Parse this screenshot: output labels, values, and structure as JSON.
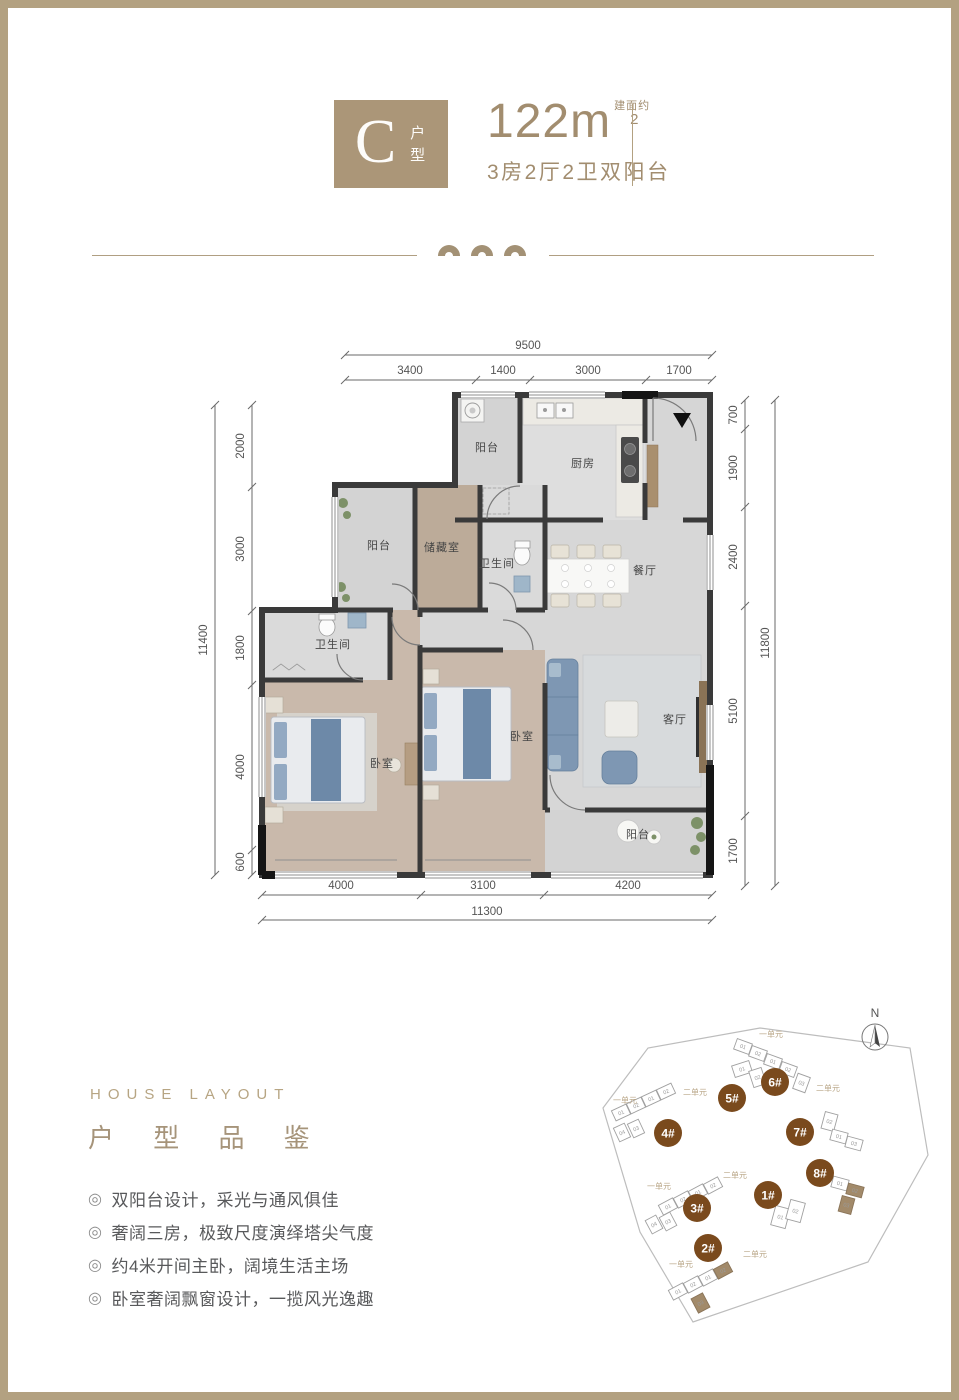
{
  "header": {
    "type_letter": "C",
    "type_label": "户型",
    "area_value": "122",
    "area_unit": "m",
    "area_note": "建面约",
    "area_sup": "2",
    "description": "3房2厅2卫双阳台"
  },
  "floorplan": {
    "dims_top": {
      "total": "9500",
      "segments": [
        "3400",
        "1400",
        "3000",
        "1700"
      ]
    },
    "dims_left": {
      "total": "11400",
      "segments": [
        "2000",
        "3000",
        "1800",
        "4000",
        "600"
      ]
    },
    "dims_right": {
      "total": "11800",
      "segments": [
        "700",
        "1900",
        "2400",
        "5100",
        "1700"
      ]
    },
    "dims_bottom": {
      "total": "11300",
      "segments": [
        "4000",
        "3100",
        "4200"
      ]
    },
    "rooms": {
      "balcony_top": "阳台",
      "kitchen": "厨房",
      "balcony_mid": "阳台",
      "storage": "储藏室",
      "bath_upper": "卫生间",
      "dining": "餐厅",
      "bath_lower": "卫生间",
      "bedroom_master": "卧室",
      "bedroom_second": "卧室",
      "living": "客厅",
      "balcony_bottom": "阳台"
    }
  },
  "layout_section": {
    "heading_en": "HOUSE LAYOUT",
    "heading_zh": "户 型 品 鉴",
    "bullet_marker": "◎",
    "bullets": [
      "双阳台设计，采光与通风俱佳",
      "奢阔三房，极致尺度演绎塔尖气度",
      "约4米开间主卧，阔境生活主场",
      "卧室奢阔飘窗设计，一揽风光逸趣"
    ]
  },
  "sitemap": {
    "compass_label": "N",
    "building_color": "#7a4a1d",
    "highlight_color": "#a28a6a",
    "buildings": [
      {
        "id": "1#",
        "x": 183,
        "y": 200,
        "units": [
          {
            "x": 188,
            "y": 212,
            "w": 15,
            "h": 20,
            "r": 15,
            "n": "01"
          },
          {
            "x": 203,
            "y": 206,
            "w": 15,
            "h": 20,
            "r": 15,
            "n": "02"
          }
        ],
        "labels": []
      },
      {
        "id": "2#",
        "x": 123,
        "y": 253,
        "units": [
          {
            "x": 85,
            "y": 291,
            "w": 16,
            "h": 11,
            "r": -28,
            "n": "01"
          },
          {
            "x": 100,
            "y": 284,
            "w": 16,
            "h": 11,
            "r": -28,
            "n": "02"
          },
          {
            "x": 115,
            "y": 277,
            "w": 16,
            "h": 11,
            "r": -28,
            "n": "01"
          },
          {
            "x": 130,
            "y": 270,
            "w": 16,
            "h": 11,
            "r": -28,
            "n": "02",
            "hl": true
          },
          {
            "x": 109,
            "y": 300,
            "w": 13,
            "h": 16,
            "r": -28,
            "n": "03",
            "hl": true
          }
        ],
        "labels": [
          {
            "x": 96,
            "y": 272,
            "t": "一单元"
          },
          {
            "x": 170,
            "y": 262,
            "t": "二单元"
          }
        ]
      },
      {
        "id": "3#",
        "x": 112,
        "y": 213,
        "units": [
          {
            "x": 75,
            "y": 206,
            "w": 16,
            "h": 11,
            "r": -28,
            "n": "01"
          },
          {
            "x": 90,
            "y": 199,
            "w": 16,
            "h": 11,
            "r": -28,
            "n": "02"
          },
          {
            "x": 105,
            "y": 192,
            "w": 16,
            "h": 11,
            "r": -28,
            "n": "01"
          },
          {
            "x": 120,
            "y": 185,
            "w": 16,
            "h": 11,
            "r": -28,
            "n": "02"
          },
          {
            "x": 63,
            "y": 222,
            "w": 12,
            "h": 15,
            "r": -28,
            "n": "04"
          },
          {
            "x": 77,
            "y": 219,
            "w": 12,
            "h": 15,
            "r": -28,
            "n": "03"
          }
        ],
        "labels": [
          {
            "x": 74,
            "y": 194,
            "t": "一单元"
          },
          {
            "x": 150,
            "y": 183,
            "t": "二单元"
          }
        ]
      },
      {
        "id": "4#",
        "x": 83,
        "y": 138,
        "units": [
          {
            "x": 28,
            "y": 112,
            "w": 16,
            "h": 11,
            "r": -25,
            "n": "01"
          },
          {
            "x": 43,
            "y": 105,
            "w": 16,
            "h": 11,
            "r": -25,
            "n": "02"
          },
          {
            "x": 58,
            "y": 98,
            "w": 16,
            "h": 11,
            "r": -25,
            "n": "01"
          },
          {
            "x": 73,
            "y": 91,
            "w": 16,
            "h": 11,
            "r": -25,
            "n": "02"
          },
          {
            "x": 31,
            "y": 130,
            "w": 12,
            "h": 15,
            "r": -25,
            "n": "04"
          },
          {
            "x": 45,
            "y": 126,
            "w": 12,
            "h": 15,
            "r": -25,
            "n": "03"
          }
        ],
        "labels": [
          {
            "x": 40,
            "y": 108,
            "t": "一单元"
          },
          {
            "x": 110,
            "y": 100,
            "t": "二单元"
          }
        ]
      },
      {
        "id": "5#",
        "x": 147,
        "y": 103,
        "units": [
          {
            "x": 148,
            "y": 68,
            "w": 18,
            "h": 12,
            "r": -18,
            "n": "01"
          },
          {
            "x": 166,
            "y": 74,
            "w": 13,
            "h": 17,
            "r": -18,
            "n": "02"
          }
        ],
        "labels": []
      },
      {
        "id": "6#",
        "x": 190,
        "y": 87,
        "units": [
          {
            "x": 150,
            "y": 46,
            "w": 16,
            "h": 11,
            "r": 20,
            "n": "01"
          },
          {
            "x": 165,
            "y": 53,
            "w": 16,
            "h": 11,
            "r": 20,
            "n": "02"
          },
          {
            "x": 180,
            "y": 61,
            "w": 16,
            "h": 11,
            "r": 20,
            "n": "01"
          },
          {
            "x": 195,
            "y": 69,
            "w": 16,
            "h": 11,
            "r": 20,
            "n": "02"
          },
          {
            "x": 210,
            "y": 80,
            "w": 13,
            "h": 16,
            "r": 20,
            "n": "03"
          }
        ],
        "labels": [
          {
            "x": 186,
            "y": 42,
            "t": "一单元"
          },
          {
            "x": 243,
            "y": 96,
            "t": "二单元"
          }
        ]
      },
      {
        "id": "7#",
        "x": 215,
        "y": 137,
        "units": [
          {
            "x": 238,
            "y": 118,
            "w": 13,
            "h": 17,
            "r": 15,
            "n": "02"
          },
          {
            "x": 246,
            "y": 136,
            "w": 16,
            "h": 11,
            "r": 15,
            "n": "01"
          },
          {
            "x": 261,
            "y": 143,
            "w": 16,
            "h": 11,
            "r": 15,
            "n": "03"
          }
        ],
        "labels": []
      },
      {
        "id": "8#",
        "x": 235,
        "y": 178,
        "units": [
          {
            "x": 247,
            "y": 183,
            "w": 16,
            "h": 11,
            "r": 15,
            "n": "01"
          },
          {
            "x": 262,
            "y": 190,
            "w": 16,
            "h": 11,
            "r": 15,
            "n": "02",
            "hl": true
          },
          {
            "x": 255,
            "y": 202,
            "w": 13,
            "h": 16,
            "r": 15,
            "n": "03",
            "hl": true
          }
        ],
        "labels": []
      }
    ]
  }
}
